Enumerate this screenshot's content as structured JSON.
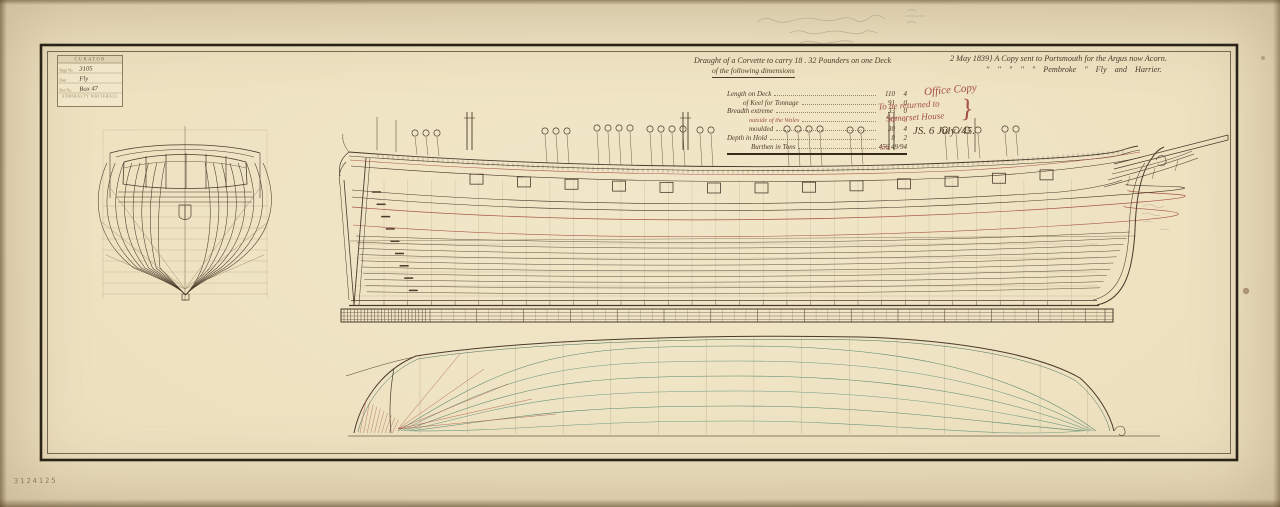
{
  "colors": {
    "ink": "#4a3b2c",
    "ink_light": "#8a7a5e",
    "faint": "#b1a388",
    "red": "#a8564a",
    "green": "#57876b",
    "green_light": "#6f9a82",
    "pencil": "#b5aa90",
    "paper": "#ece1bf"
  },
  "stamp": {
    "header": "CURATOR",
    "rows": [
      {
        "label": "Regn No.",
        "value": "3105"
      },
      {
        "label": "Date",
        "value": "Fly"
      },
      {
        "label": "Box No.",
        "value": "Box 47"
      }
    ],
    "footer": "ADMIRALTY WHITEHALL"
  },
  "title": {
    "line1": "Draught of a Corvette to carry 18 . 32 Pounders on one Deck",
    "line2": "of the following dimensions"
  },
  "dimensions": {
    "rows": [
      {
        "label": "Length on Deck",
        "ft": "110",
        "in": "4"
      },
      {
        "label": "of Keel for Tonnage",
        "ft": "91",
        "in": "0"
      },
      {
        "label": "Breadth extreme",
        "ft": "33",
        "in": "0"
      },
      {
        "label": "outside of the Wales",
        "ft": "31",
        "in": "6"
      },
      {
        "label": "moulded",
        "ft": "30",
        "in": "4"
      },
      {
        "label": "Depth in Hold",
        "ft": "8",
        "in": "2"
      }
    ],
    "burthen_label": "Burthen in Tons",
    "burthen_value": "459 49/94",
    "burthen_correction": "579"
  },
  "inscription": {
    "date": "2 May 1839",
    "brace": "}",
    "line1": "A Copy sent to Portsmouth for the Argus now Acorn.",
    "line2": "″   ″   ″   ″   ″   Pembroke   ″   Fly and Harrier."
  },
  "office": {
    "stamp_line": "Office Copy",
    "return_line1": "To be returned to",
    "return_line2": "Somerset House",
    "brace": "}",
    "signature": "JS.  6 July /45."
  },
  "margin": {
    "negative_number": "3124125"
  }
}
